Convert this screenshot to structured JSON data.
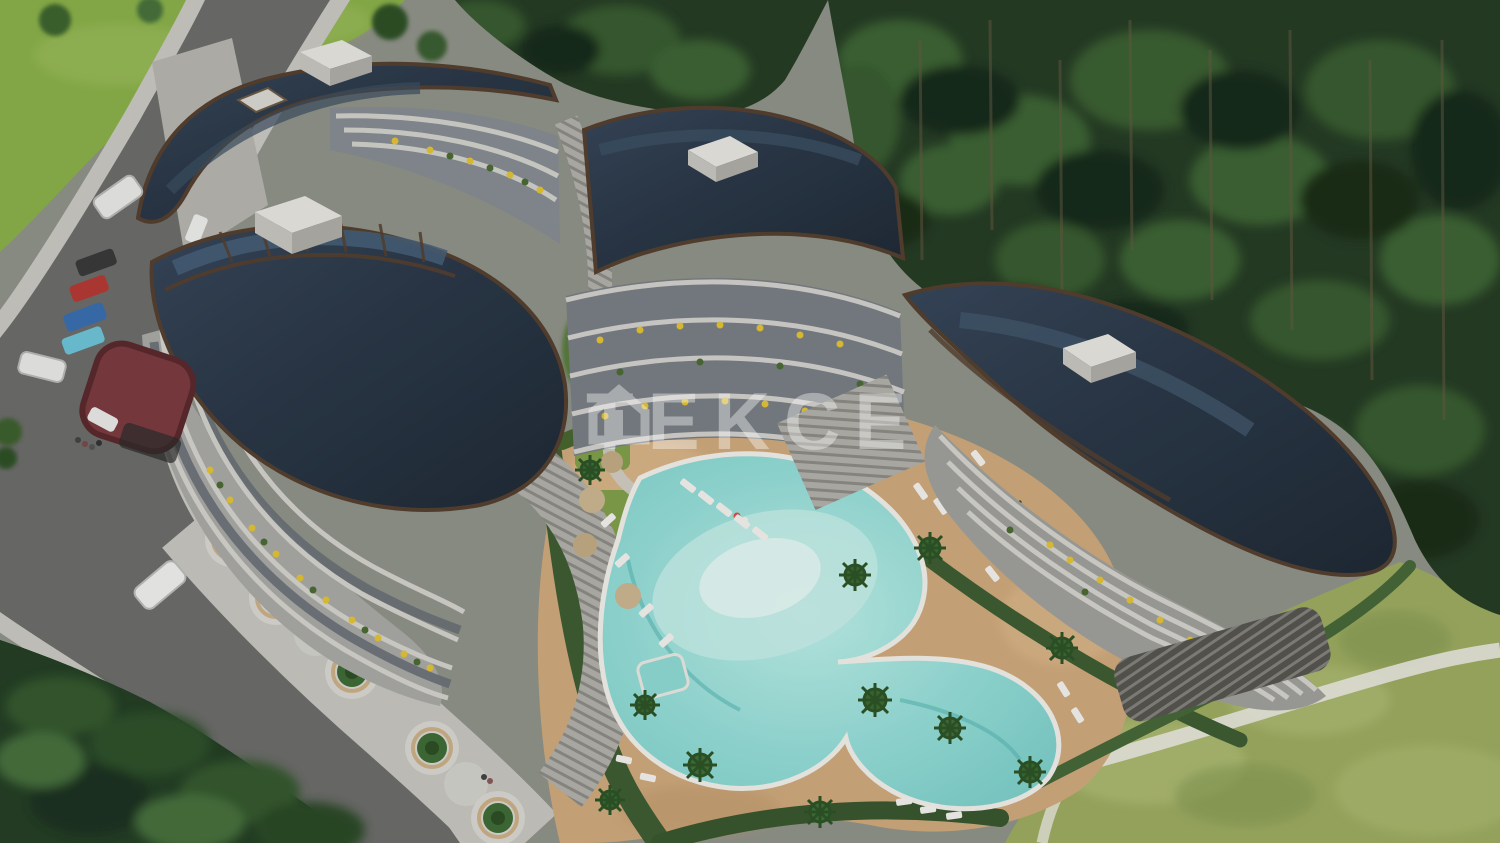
{
  "watermark": {
    "text": "TEKCE",
    "icon": "house-logo-icon",
    "color": "#ffffff",
    "opacity": 0.38
  },
  "scene": {
    "type": "aerial-architectural-render",
    "subject": "Curved residential apartment complex with landscaped swimming-pool courtyard beside a pine forest",
    "palette": {
      "roof_navy": "#2b3847",
      "roof_trim_brown": "#55402f",
      "facade_light": "#c9c8c2",
      "balcony_planter_yellow": "#e2c235",
      "entrance_canopy_maroon": "#7b3c40",
      "pool_water": "#93dcd6",
      "pool_shallow": "#d6f3ee",
      "pool_deck_tan": "#cfa97c",
      "lawn_green": "#8ab04a",
      "meadow_green": "#9cab61",
      "forest_green": "#2e4a2d",
      "asphalt_gray": "#6c6c6a",
      "sidewalk_gray": "#c8c7c2",
      "footpath_white": "#e9e8e0"
    },
    "counts": {
      "buildings": 4,
      "rooftop_boxes": 4,
      "parked_cars": 5,
      "moving_cars": 3,
      "conical_trees": 5,
      "palm_trees": 12,
      "pool_umbrellas": 3,
      "kids_pool": 1
    },
    "vehicles": {
      "parked_colors": [
        "dark-gray",
        "red",
        "blue",
        "cyan",
        "white"
      ],
      "moving_colors": [
        "white",
        "white",
        "white"
      ]
    },
    "labels": {
      "buildings": [
        "block-a-southwest",
        "block-b-northwest",
        "block-c-center",
        "block-d-east"
      ]
    }
  }
}
